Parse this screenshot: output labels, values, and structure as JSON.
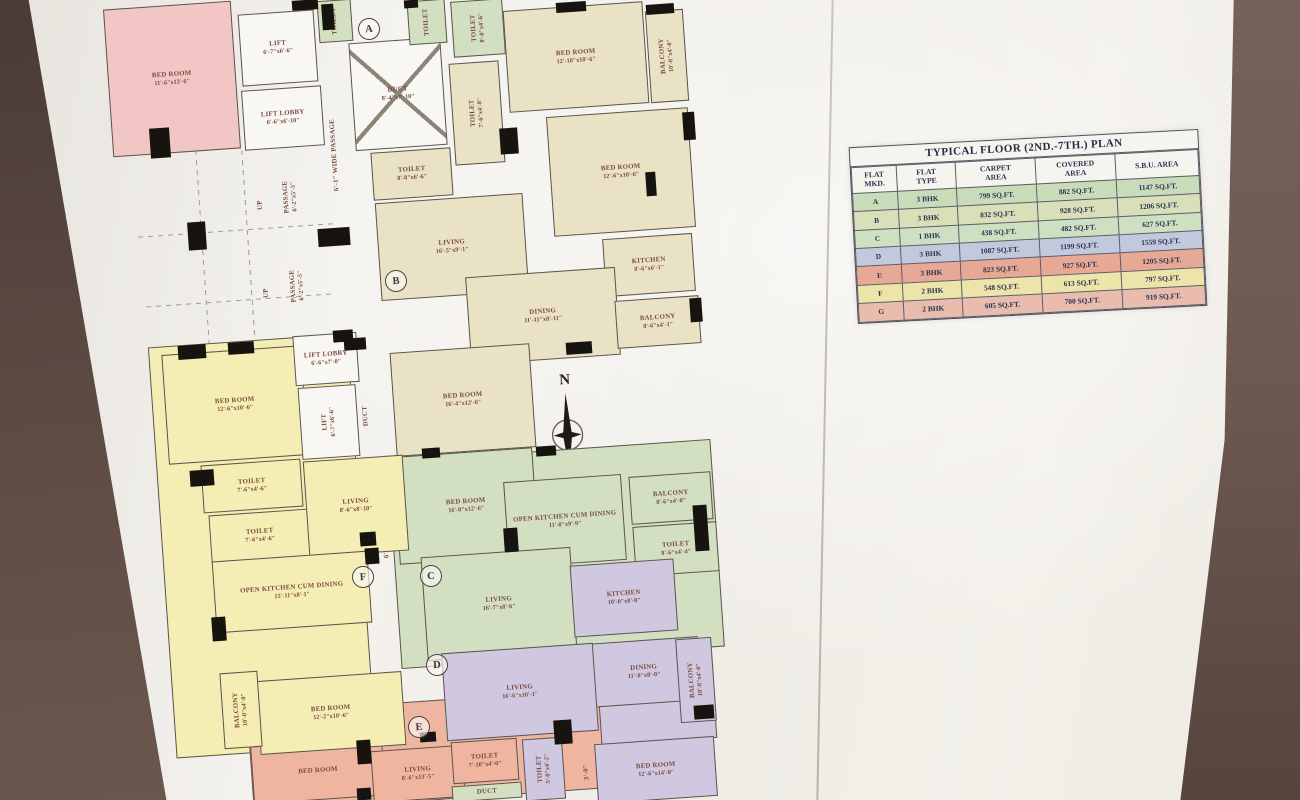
{
  "scene": {
    "wall_color": "#5f4c45",
    "paper_color": "#f2efe9"
  },
  "plan": {
    "compass_label": "N",
    "rooms": [
      {
        "n": "",
        "d": "",
        "x": 162,
        "y": 340,
        "w": 200,
        "h": 412,
        "c": "yellow"
      },
      {
        "n": "",
        "d": "",
        "x": 394,
        "y": 450,
        "w": 324,
        "h": 208,
        "c": "green"
      },
      {
        "n": "",
        "d": "",
        "x": 250,
        "y": 700,
        "w": 372,
        "h": 100,
        "c": "salmon"
      },
      {
        "n": "",
        "d": "",
        "x": 600,
        "y": 700,
        "w": 116,
        "h": 42,
        "c": "purple"
      },
      {
        "n": "BED ROOM",
        "d": "11'-6\"x13'-6\"",
        "x": 108,
        "y": 5,
        "w": 128,
        "h": 148,
        "c": "pink"
      },
      {
        "n": "LIFT",
        "d": "6'-7\"x6'-6\"",
        "x": 240,
        "y": 12,
        "w": 76,
        "h": 72,
        "c": "white"
      },
      {
        "n": "LIFT LOBBY",
        "d": "6'-6\"x6'-10\"",
        "x": 243,
        "y": 88,
        "w": 80,
        "h": 60,
        "c": "white"
      },
      {
        "n": "PASSAGE",
        "d": "6'-2\"x5'-5\"",
        "x": 266,
        "y": 158,
        "w": 48,
        "h": 78,
        "c": "label",
        "o": "v"
      },
      {
        "n": "PASSAGE",
        "d": "6'-2\"x5'-5\"",
        "x": 272,
        "y": 246,
        "w": 50,
        "h": 80,
        "c": "label",
        "o": "v"
      },
      {
        "n": "UP",
        "d": "",
        "x": 254,
        "y": 194,
        "w": 14,
        "h": 22,
        "c": "label",
        "o": "v"
      },
      {
        "n": "UP",
        "d": "",
        "x": 260,
        "y": 282,
        "w": 14,
        "h": 22,
        "c": "label",
        "o": "v"
      },
      {
        "n": "6'-1\" WIDE PASSAGE",
        "d": "",
        "x": 326,
        "y": 70,
        "w": 18,
        "h": 170,
        "c": "label",
        "o": "v"
      },
      {
        "n": "6'-1\" WIDE PASSAGE",
        "d": "",
        "x": 376,
        "y": 472,
        "w": 18,
        "h": 100,
        "c": "label",
        "o": "v"
      },
      {
        "n": "DUCT",
        "d": "8'-4\"x7'-10\"",
        "x": 352,
        "y": 40,
        "w": 92,
        "h": 108,
        "c": "duct"
      },
      {
        "n": "TOILET",
        "d": "",
        "x": 318,
        "y": 0,
        "w": 34,
        "h": 42,
        "c": "green",
        "o": "v"
      },
      {
        "n": "TOILET",
        "d": "",
        "x": 408,
        "y": 0,
        "w": 38,
        "h": 44,
        "c": "green",
        "o": "v"
      },
      {
        "n": "TOILET",
        "d": "8'-0\"x4'-6\"",
        "x": 452,
        "y": 0,
        "w": 52,
        "h": 56,
        "c": "green",
        "o": "v"
      },
      {
        "n": "TOILET",
        "d": "7'-6\"x4'-8\"",
        "x": 452,
        "y": 62,
        "w": 50,
        "h": 102,
        "c": "tan",
        "o": "v"
      },
      {
        "n": "TOILET",
        "d": "8'-8\"x6'-6\"",
        "x": 372,
        "y": 150,
        "w": 80,
        "h": 48,
        "c": "tan"
      },
      {
        "n": "BED ROOM",
        "d": "12'-10\"x10'-6\"",
        "x": 506,
        "y": 6,
        "w": 140,
        "h": 102,
        "c": "tan"
      },
      {
        "n": "BALCONY",
        "d": "10'-8\"x4'-0\"",
        "x": 648,
        "y": 10,
        "w": 38,
        "h": 92,
        "c": "tan",
        "o": "v"
      },
      {
        "n": "BED ROOM",
        "d": "12'-6\"x10'-6\"",
        "x": 550,
        "y": 112,
        "w": 142,
        "h": 120,
        "c": "tan"
      },
      {
        "n": "KITCHEN",
        "d": "8'-6\"x6'-1\"",
        "x": 604,
        "y": 236,
        "w": 90,
        "h": 58,
        "c": "tan"
      },
      {
        "n": "LIVING",
        "d": "16'-5\"x9'-1\"",
        "x": 378,
        "y": 198,
        "w": 148,
        "h": 98,
        "c": "tan"
      },
      {
        "n": "DINING",
        "d": "11'-11\"x8'-11\"",
        "x": 468,
        "y": 272,
        "w": 150,
        "h": 88,
        "c": "tan"
      },
      {
        "n": "BALCONY",
        "d": "8'-6\"x4'-1\"",
        "x": 616,
        "y": 298,
        "w": 84,
        "h": 48,
        "c": "tan"
      },
      {
        "n": "BED ROOM",
        "d": "16'-4\"x12'-6\"",
        "x": 393,
        "y": 348,
        "w": 140,
        "h": 104,
        "c": "tan"
      },
      {
        "n": "BED ROOM",
        "d": "16'-0\"x12'-6\"",
        "x": 396,
        "y": 452,
        "w": 140,
        "h": 108,
        "c": "green"
      },
      {
        "n": "OPEN KITCHEN CUM DINING",
        "d": "11'-0\"x9'-9\"",
        "x": 506,
        "y": 478,
        "w": 118,
        "h": 86,
        "c": "green"
      },
      {
        "n": "BALCONY",
        "d": "8'-6\"x4'-0\"",
        "x": 630,
        "y": 474,
        "w": 82,
        "h": 48,
        "c": "green"
      },
      {
        "n": "TOILET",
        "d": "8'-6\"x4'-4\"",
        "x": 634,
        "y": 524,
        "w": 84,
        "h": 50,
        "c": "green"
      },
      {
        "n": "LIVING",
        "d": "16'-7\"x8'-6\"",
        "x": 424,
        "y": 552,
        "w": 150,
        "h": 104,
        "c": "green"
      },
      {
        "n": "KITCHEN",
        "d": "10'-0\"x8'-0\"",
        "x": 572,
        "y": 562,
        "w": 104,
        "h": 72,
        "c": "purple"
      },
      {
        "n": "DINING",
        "d": "11'-0\"x8'-0\"",
        "x": 588,
        "y": 640,
        "w": 112,
        "h": 64,
        "c": "purple"
      },
      {
        "n": "BALCONY",
        "d": "10'-8\"x4'-0\"",
        "x": 678,
        "y": 638,
        "w": 36,
        "h": 84,
        "c": "purple",
        "o": "v"
      },
      {
        "n": "LIVING",
        "d": "16'-6\"x10'-1\"",
        "x": 444,
        "y": 648,
        "w": 152,
        "h": 88,
        "c": "purple"
      },
      {
        "n": "BED ROOM",
        "d": "12'-6\"x14'-0\"",
        "x": 596,
        "y": 740,
        "w": 120,
        "h": 60,
        "c": "purple"
      },
      {
        "n": "TOILET",
        "d": "5'-0\"x4'-2\"",
        "x": 524,
        "y": 738,
        "w": 40,
        "h": 62,
        "c": "purple",
        "o": "v"
      },
      {
        "n": "3'-0\"",
        "d": "",
        "x": 576,
        "y": 752,
        "w": 22,
        "h": 40,
        "c": "label",
        "o": "v"
      },
      {
        "n": "BED ROOM",
        "d": "",
        "x": 252,
        "y": 742,
        "w": 132,
        "h": 58,
        "c": "salmon"
      },
      {
        "n": "LIVING",
        "d": "8'-6\"x13'-5\"",
        "x": 372,
        "y": 748,
        "w": 92,
        "h": 52,
        "c": "salmon"
      },
      {
        "n": "TOILET",
        "d": "7'-10\"x4'-0\"",
        "x": 452,
        "y": 740,
        "w": 66,
        "h": 42,
        "c": "salmon"
      },
      {
        "n": "DUCT",
        "d": "",
        "x": 452,
        "y": 784,
        "w": 70,
        "h": 16,
        "c": "green"
      },
      {
        "n": "BED ROOM",
        "d": "12'-6\"x10'-6\"",
        "x": 165,
        "y": 350,
        "w": 140,
        "h": 110,
        "c": "yellow"
      },
      {
        "n": "LIFT LOBBY",
        "d": "6'-6\"x7'-0\"",
        "x": 294,
        "y": 334,
        "w": 64,
        "h": 50,
        "c": "white"
      },
      {
        "n": "LIFT",
        "d": "6'-7\"x6'-6\"",
        "x": 300,
        "y": 386,
        "w": 58,
        "h": 72,
        "c": "white",
        "o": "v"
      },
      {
        "n": "DUCT",
        "d": "",
        "x": 358,
        "y": 388,
        "w": 16,
        "h": 56,
        "c": "label",
        "o": "v"
      },
      {
        "n": "TOILET",
        "d": "7'-6\"x4'-6\"",
        "x": 202,
        "y": 462,
        "w": 100,
        "h": 48,
        "c": "yellow"
      },
      {
        "n": "TOILET",
        "d": "7'-6\"x4'-6\"",
        "x": 210,
        "y": 512,
        "w": 100,
        "h": 48,
        "c": "yellow"
      },
      {
        "n": "LIVING",
        "d": "8'-6\"x8'-10\"",
        "x": 306,
        "y": 458,
        "w": 100,
        "h": 96,
        "c": "yellow"
      },
      {
        "n": "OPEN KITCHEN CUM DINING",
        "d": "15'-11\"x8'-1\"",
        "x": 214,
        "y": 556,
        "w": 156,
        "h": 72,
        "c": "yellow"
      },
      {
        "n": "BED ROOM",
        "d": "12'-2\"x10'-6\"",
        "x": 258,
        "y": 676,
        "w": 146,
        "h": 74,
        "c": "yellow"
      },
      {
        "n": "BALCONY",
        "d": "10'-0\"x4'-0\"",
        "x": 222,
        "y": 672,
        "w": 38,
        "h": 76,
        "c": "yellow",
        "o": "v"
      }
    ],
    "markers": [
      {
        "label": "A",
        "x": 368,
        "y": 28
      },
      {
        "label": "B",
        "x": 395,
        "y": 280
      },
      {
        "label": "C",
        "x": 430,
        "y": 575
      },
      {
        "label": "D",
        "x": 436,
        "y": 664
      },
      {
        "label": "E",
        "x": 418,
        "y": 726
      },
      {
        "label": "F",
        "x": 362,
        "y": 576
      }
    ],
    "columns": [
      [
        292,
        0,
        26,
        10
      ],
      [
        404,
        0,
        14,
        8
      ],
      [
        556,
        2,
        30,
        10
      ],
      [
        646,
        4,
        28,
        10
      ],
      [
        322,
        4,
        12,
        26
      ],
      [
        150,
        128,
        20,
        30
      ],
      [
        188,
        222,
        18,
        28
      ],
      [
        318,
        228,
        32,
        18
      ],
      [
        500,
        128,
        18,
        26
      ],
      [
        683,
        112,
        12,
        28
      ],
      [
        646,
        172,
        10,
        24
      ],
      [
        690,
        298,
        12,
        24
      ],
      [
        566,
        342,
        26,
        12
      ],
      [
        228,
        342,
        26,
        12
      ],
      [
        344,
        338,
        22,
        12
      ],
      [
        178,
        345,
        28,
        14
      ],
      [
        333,
        330,
        20,
        12
      ],
      [
        190,
        470,
        24,
        16
      ],
      [
        360,
        532,
        16,
        14
      ],
      [
        212,
        617,
        14,
        24
      ],
      [
        365,
        548,
        14,
        16
      ],
      [
        504,
        528,
        14,
        24
      ],
      [
        694,
        505,
        14,
        46
      ],
      [
        554,
        720,
        18,
        24
      ],
      [
        694,
        705,
        20,
        14
      ],
      [
        357,
        740,
        14,
        24
      ],
      [
        357,
        788,
        14,
        12
      ],
      [
        422,
        448,
        18,
        10
      ],
      [
        536,
        446,
        20,
        10
      ],
      [
        420,
        732,
        16,
        10
      ]
    ]
  },
  "table": {
    "title": "TYPICAL FLOOR (2ND.-7TH.) PLAN",
    "headers": [
      [
        "FLAT",
        "MKD."
      ],
      [
        "FLAT",
        "TYPE"
      ],
      [
        "CARPET",
        "AREA"
      ],
      [
        "COVERED",
        "AREA"
      ],
      [
        "S.B.U. AREA"
      ]
    ],
    "rows": [
      {
        "mkd": "A",
        "type": "3 BHK",
        "carpet": "799 SQ.FT.",
        "covered": "882 SQ.FT.",
        "sbu": "1147 SQ.FT.",
        "color": "green"
      },
      {
        "mkd": "B",
        "type": "3 BHK",
        "carpet": "832 SQ.FT.",
        "covered": "928 SQ.FT.",
        "sbu": "1206 SQ.FT.",
        "color": "olive"
      },
      {
        "mkd": "C",
        "type": "1 BHK",
        "carpet": "438 SQ.FT.",
        "covered": "482 SQ.FT.",
        "sbu": "627 SQ.FT.",
        "color": "green2"
      },
      {
        "mkd": "D",
        "type": "3 BHK",
        "carpet": "1087 SQ.FT.",
        "covered": "1199 SQ.FT.",
        "sbu": "1559 SQ.FT.",
        "color": "lavender"
      },
      {
        "mkd": "E",
        "type": "3 BHK",
        "carpet": "823 SQ.FT.",
        "covered": "927 SQ.FT.",
        "sbu": "1205 SQ.FT.",
        "color": "salmonrow"
      },
      {
        "mkd": "F",
        "type": "2 BHK",
        "carpet": "548 SQ.FT.",
        "covered": "613 SQ.FT.",
        "sbu": "797 SQ.FT.",
        "color": "yellowrow"
      },
      {
        "mkd": "G",
        "type": "2 BHK",
        "carpet": "605 SQ.FT.",
        "covered": "700 SQ.FT.",
        "sbu": "919 SQ.FT.",
        "color": "pinkrow"
      }
    ]
  }
}
